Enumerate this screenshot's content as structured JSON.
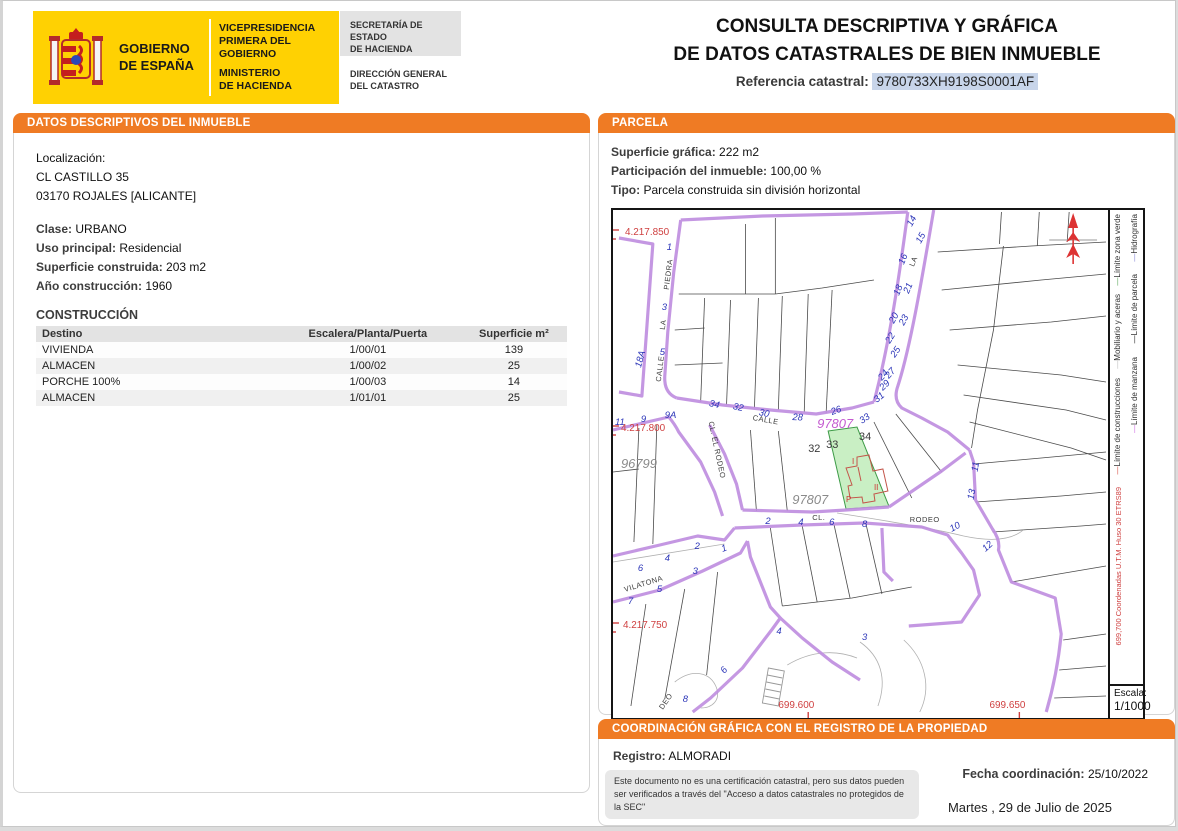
{
  "header": {
    "gobierno_line1": "GOBIERNO",
    "gobierno_line2": "DE ESPAÑA",
    "dept1_line1": "VICEPRESIDENCIA",
    "dept1_line2": "PRIMERA DEL GOBIERNO",
    "dept2_line1": "MINISTERIO",
    "dept2_line2": "DE HACIENDA",
    "secretaria_line1": "SECRETARÍA DE ESTADO",
    "secretaria_line2": "DE HACIENDA",
    "direccion_line1": "DIRECCIÓN GENERAL",
    "direccion_line2": "DEL CATASTRO",
    "title_line1": "CONSULTA DESCRIPTIVA Y GRÁFICA",
    "title_line2": "DE DATOS CATASTRALES DE BIEN INMUEBLE",
    "ref_label": "Referencia catastral:",
    "ref_value": "9780733XH9198S0001AF"
  },
  "left_panel": {
    "header": "DATOS DESCRIPTIVOS DEL INMUEBLE",
    "localizacion_label": "Localización:",
    "address_line1": "CL CASTILLO 35",
    "address_line2": "03170 ROJALES [ALICANTE]",
    "fields": [
      {
        "label": "Clase:",
        "value": "URBANO"
      },
      {
        "label": "Uso principal:",
        "value": "Residencial"
      },
      {
        "label": "Superficie construida:",
        "value": "203 m2"
      },
      {
        "label": "Año construcción:",
        "value": "1960"
      }
    ],
    "construccion_title": "CONSTRUCCIÓN",
    "table": {
      "headers": [
        "Destino",
        "Escalera/Planta/Puerta",
        "Superficie m²"
      ],
      "rows": [
        [
          "VIVIENDA",
          "1/00/01",
          "139"
        ],
        [
          "ALMACEN",
          "1/00/02",
          "25"
        ],
        [
          "PORCHE 100%",
          "1/00/03",
          "14"
        ],
        [
          "ALMACEN",
          "1/01/01",
          "25"
        ]
      ]
    }
  },
  "parcela": {
    "header": "PARCELA",
    "fields": [
      {
        "label": "Superficie gráfica:",
        "value": "222 m2"
      },
      {
        "label": "Participación del inmueble:",
        "value": "100,00 %"
      },
      {
        "label": "Tipo:",
        "value": "Parcela construida sin división horizontal"
      }
    ]
  },
  "map": {
    "legend": {
      "right_column": [
        {
          "label": "Hidrografía",
          "color": "#8585d6"
        },
        {
          "label": "Límite de parcela",
          "color": "#222222"
        },
        {
          "label": "Límite de manzana",
          "color": "#cf6ee4"
        }
      ],
      "left_column": [
        {
          "label": "Límite zona verde",
          "color": "#5aa85a"
        },
        {
          "label": "Mobiliario y aceras",
          "color": "#bfbfbf"
        },
        {
          "label": "Límite de construcciones",
          "color": "#d94f43"
        }
      ],
      "coords_note": "699,700 Coordenadas U.T.M. Huso 30 ETRS89",
      "coords_note_color": "#cf4040",
      "escala_label": "Escala:",
      "escala_value": "1/1000"
    },
    "labels": [
      {
        "t": "4.217.850",
        "x": 12,
        "y": 25,
        "c": "red"
      },
      {
        "t": "4.217.800",
        "x": 8,
        "y": 221,
        "c": "red"
      },
      {
        "t": "4.217.750",
        "x": 10,
        "y": 418,
        "c": "red"
      },
      {
        "t": "699.600",
        "x": 166,
        "y": 498,
        "c": "red"
      },
      {
        "t": "699.650",
        "x": 378,
        "y": 498,
        "c": "red"
      },
      {
        "t": "96799",
        "x": 8,
        "y": 258,
        "c": "gray"
      },
      {
        "t": "97807",
        "x": 180,
        "y": 294,
        "c": "gray"
      },
      {
        "t": "97807",
        "x": 205,
        "y": 218,
        "c": "mag"
      },
      {
        "t": "PIEDRA",
        "x": 56,
        "y": 80,
        "c": "st",
        "r": -83
      },
      {
        "t": "LA",
        "x": 52,
        "y": 120,
        "c": "st",
        "r": -83
      },
      {
        "t": "CALLE",
        "x": 48,
        "y": 172,
        "c": "st",
        "r": -83
      },
      {
        "t": "CALLE",
        "x": 140,
        "y": 210,
        "c": "st",
        "r": 10
      },
      {
        "t": "CL. EL RODEO",
        "x": 96,
        "y": 212,
        "c": "st",
        "r": 78
      },
      {
        "t": "CL.",
        "x": 200,
        "y": 310,
        "c": "st"
      },
      {
        "t": "RODEO",
        "x": 298,
        "y": 312,
        "c": "st"
      },
      {
        "t": "VILATONA",
        "x": 12,
        "y": 382,
        "c": "st",
        "r": -17
      },
      {
        "t": "DEO",
        "x": 50,
        "y": 500,
        "c": "st",
        "r": -55
      },
      {
        "t": "LA",
        "x": 302,
        "y": 57,
        "c": "st",
        "r": -68
      },
      {
        "t": "1",
        "x": 54,
        "y": 40,
        "c": "blue"
      },
      {
        "t": "3",
        "x": 49,
        "y": 100,
        "c": "blue"
      },
      {
        "t": "5",
        "x": 47,
        "y": 145,
        "c": "blue"
      },
      {
        "t": "18A",
        "x": 28,
        "y": 158,
        "c": "blue",
        "r": -75
      },
      {
        "t": "11",
        "x": 2,
        "y": 215,
        "c": "blue"
      },
      {
        "t": "9",
        "x": 28,
        "y": 212,
        "c": "blue"
      },
      {
        "t": "9A",
        "x": 52,
        "y": 208,
        "c": "blue"
      },
      {
        "t": "34",
        "x": 96,
        "y": 196,
        "c": "blue",
        "r": 12
      },
      {
        "t": "32",
        "x": 120,
        "y": 199,
        "c": "blue",
        "r": 12
      },
      {
        "t": "30",
        "x": 146,
        "y": 205,
        "c": "blue",
        "r": 12
      },
      {
        "t": "28",
        "x": 180,
        "y": 210,
        "c": "blue",
        "r": 3
      },
      {
        "t": "26",
        "x": 220,
        "y": 205,
        "c": "blue",
        "r": -20
      },
      {
        "t": "33",
        "x": 250,
        "y": 214,
        "c": "blue",
        "r": -35
      },
      {
        "t": "14",
        "x": 300,
        "y": 17,
        "c": "blue",
        "r": -62
      },
      {
        "t": "15",
        "x": 309,
        "y": 34,
        "c": "blue",
        "r": -62
      },
      {
        "t": "16",
        "x": 292,
        "y": 55,
        "c": "blue",
        "r": -68
      },
      {
        "t": "18",
        "x": 287,
        "y": 86,
        "c": "blue",
        "r": -68
      },
      {
        "t": "21",
        "x": 297,
        "y": 84,
        "c": "blue",
        "r": -68
      },
      {
        "t": "20",
        "x": 282,
        "y": 114,
        "c": "blue",
        "r": -62
      },
      {
        "t": "23",
        "x": 292,
        "y": 116,
        "c": "blue",
        "r": -62
      },
      {
        "t": "22",
        "x": 278,
        "y": 134,
        "c": "blue",
        "r": -58
      },
      {
        "t": "25",
        "x": 283,
        "y": 148,
        "c": "blue",
        "r": -55
      },
      {
        "t": "24",
        "x": 270,
        "y": 171,
        "c": "blue",
        "r": -48
      },
      {
        "t": "27",
        "x": 277,
        "y": 169,
        "c": "blue",
        "r": -48
      },
      {
        "t": "29",
        "x": 271,
        "y": 181,
        "c": "blue",
        "r": -44
      },
      {
        "t": "31",
        "x": 265,
        "y": 193,
        "c": "blue",
        "r": -40
      },
      {
        "t": "2",
        "x": 153,
        "y": 314,
        "c": "blue"
      },
      {
        "t": "4",
        "x": 186,
        "y": 315,
        "c": "blue"
      },
      {
        "t": "6",
        "x": 217,
        "y": 315,
        "c": "blue"
      },
      {
        "t": "8",
        "x": 250,
        "y": 317,
        "c": "blue"
      },
      {
        "t": "10",
        "x": 340,
        "y": 322,
        "c": "blue",
        "r": -28
      },
      {
        "t": "12",
        "x": 374,
        "y": 342,
        "c": "blue",
        "r": -42
      },
      {
        "t": "11",
        "x": 366,
        "y": 262,
        "c": "blue",
        "r": -80
      },
      {
        "t": "13",
        "x": 362,
        "y": 290,
        "c": "blue",
        "r": -80
      },
      {
        "t": "3",
        "x": 250,
        "y": 430,
        "c": "blue"
      },
      {
        "t": "6",
        "x": 25,
        "y": 361,
        "c": "blue"
      },
      {
        "t": "4",
        "x": 52,
        "y": 351,
        "c": "blue"
      },
      {
        "t": "2",
        "x": 82,
        "y": 339,
        "c": "blue"
      },
      {
        "t": "7",
        "x": 15,
        "y": 394,
        "c": "blue"
      },
      {
        "t": "5",
        "x": 44,
        "y": 382,
        "c": "blue"
      },
      {
        "t": "3",
        "x": 80,
        "y": 364,
        "c": "blue"
      },
      {
        "t": "1",
        "x": 110,
        "y": 342,
        "c": "blue",
        "r": -20
      },
      {
        "t": "4",
        "x": 164,
        "y": 424,
        "c": "blue"
      },
      {
        "t": "6",
        "x": 112,
        "y": 464,
        "c": "blue",
        "r": -50
      },
      {
        "t": "8",
        "x": 70,
        "y": 492,
        "c": "blue"
      },
      {
        "t": "32",
        "x": 196,
        "y": 242,
        "c": "blk"
      },
      {
        "t": "33",
        "x": 214,
        "y": 238,
        "c": "blk"
      },
      {
        "t": "34",
        "x": 247,
        "y": 230,
        "c": "blk"
      },
      {
        "t": "I",
        "x": 240,
        "y": 254,
        "c": "redsm"
      },
      {
        "t": "II",
        "x": 262,
        "y": 280,
        "c": "redsm"
      },
      {
        "t": "P",
        "x": 234,
        "y": 292,
        "c": "redsm"
      }
    ]
  },
  "coordinacion": {
    "header": "COORDINACIÓN GRÁFICA CON EL REGISTRO DE LA PROPIEDAD",
    "registro_label": "Registro:",
    "registro_value": "ALMORADI",
    "codigo_label": "Código registral único:",
    "codigo_value": "03057000889453",
    "fecha_label": "Fecha coordinación:",
    "fecha_value": "25/10/2022",
    "disclaimer": "Este documento no es una certificación catastral, pero sus datos pueden ser verificados a través del \"Acceso a datos catastrales no protegidos de la SEC\"",
    "date_line": "Martes , 29 de Julio de 2025"
  },
  "colors": {
    "accent_orange": "#ef7b24",
    "logo_yellow": "#ffd102",
    "ref_highlight": "#c8d5ea",
    "manzana_purple": "#c08fe0",
    "parcel_green_fill": "#c9efc4",
    "parcel_green_stroke": "#3d9b47",
    "construction_red": "#c3554a",
    "coord_red": "#cf4040",
    "street_number_blue": "#2b35b8"
  }
}
